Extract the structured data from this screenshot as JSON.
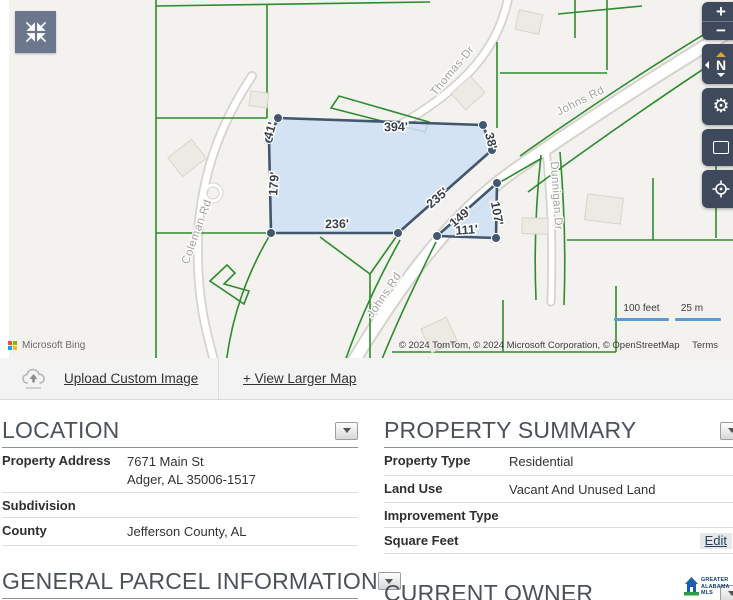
{
  "map": {
    "road_labels": {
      "thomas": "Thomas-Dr",
      "johns_upper": "Johns Rd",
      "johns_lower": "Johns Rd",
      "coleman": "Coleman Rd",
      "dunnigan": "Dunnigan Dr"
    },
    "parcel_dimensions": {
      "top": "394'",
      "upper_left": "41'",
      "left": "179'",
      "bottom": "236'",
      "diagonal": "235'",
      "right": "38'",
      "tri_hyp": "149'",
      "tri_right": "107'",
      "tri_bottom": "111'"
    },
    "controls": {
      "zoom_in": "+",
      "zoom_out": "−",
      "compass": "N"
    },
    "scale": {
      "feet": "100 feet",
      "meters": "25 m"
    },
    "attribution": "Microsoft Bing",
    "copyright": "© 2024 TomTom, © 2024 Microsoft Corporation, © OpenStreetMap",
    "terms": "Terms",
    "colors": {
      "parcel_line": "#2e8b2e",
      "highlight_fill": "#cfe0f4",
      "highlight_stroke": "#42566e",
      "control_bg": "#3e4a5b"
    }
  },
  "toolbar": {
    "upload": "Upload Custom Image",
    "view_larger": "+ View Larger Map"
  },
  "sections": {
    "location": {
      "title": "LOCATION",
      "rows": [
        {
          "label": "Property Address",
          "value": "7671 Main St",
          "value2": "Adger, AL 35006-1517"
        },
        {
          "label": "Subdivision",
          "value": ""
        },
        {
          "label": "County",
          "value": "Jefferson County, AL"
        }
      ]
    },
    "property_summary": {
      "title": "PROPERTY SUMMARY",
      "rows": [
        {
          "label": "Property Type",
          "value": "Residential"
        },
        {
          "label": "Land Use",
          "value": "Vacant And Unused Land"
        },
        {
          "label": "Improvement Type",
          "value": ""
        },
        {
          "label": "Square Feet",
          "value": "",
          "action": "Edit"
        }
      ]
    },
    "general_parcel": {
      "title": "GENERAL PARCEL INFORMATION",
      "rows": [
        {
          "label": "Parcel ID/Tax ID",
          "value": "37-00-19-0-000-128.000"
        }
      ]
    },
    "current_owner": {
      "title": "CURRENT OWNER"
    }
  },
  "mls_logo": {
    "line1": "GREATER",
    "line2": "ALABAMA",
    "line3": "MLS"
  }
}
